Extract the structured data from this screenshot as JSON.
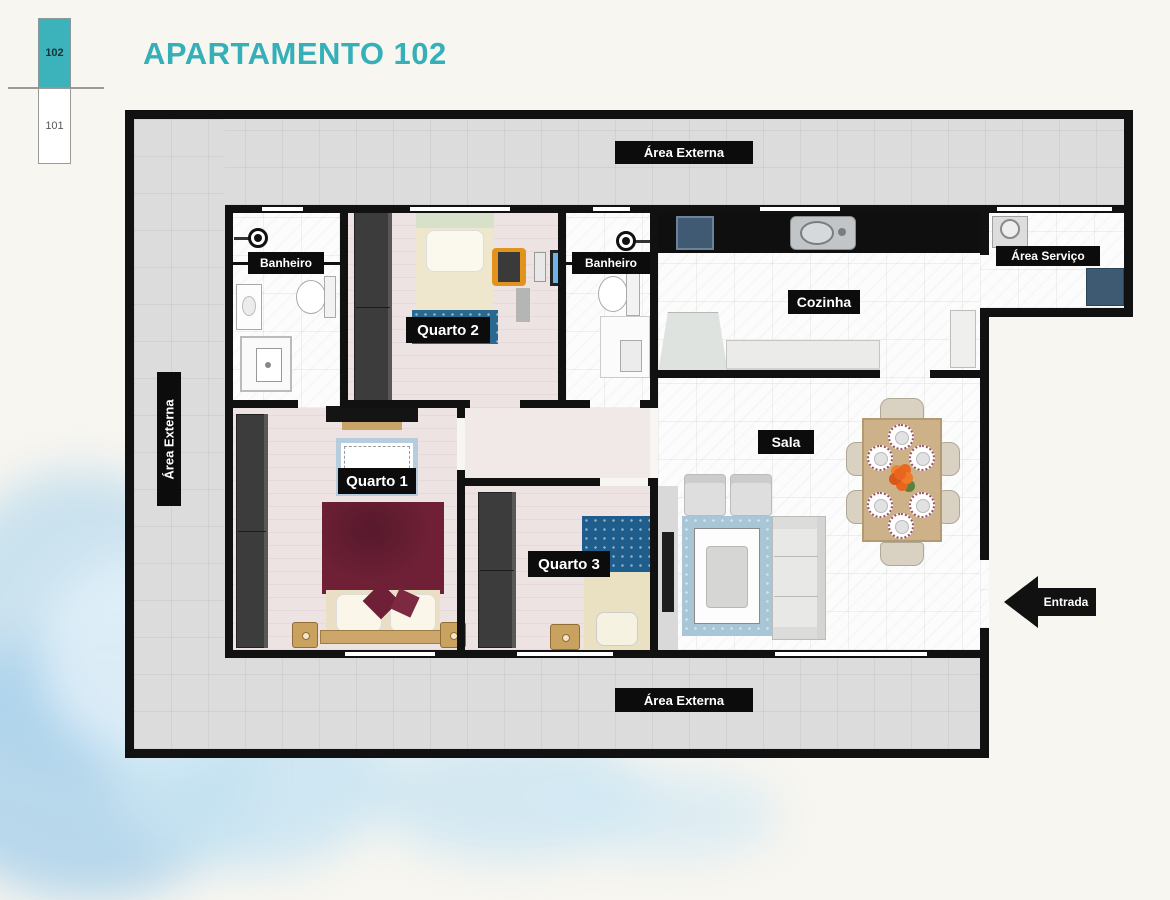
{
  "title": "APARTAMENTO 102",
  "unit_selector": {
    "selected": "102",
    "other": "101"
  },
  "floor_plan": {
    "rooms": {
      "banheiro": "Banheiro",
      "quarto1": "Quarto 1",
      "quarto2": "Quarto 2",
      "quarto3": "Quarto 3",
      "cozinha": "Cozinha",
      "sala": "Sala",
      "area_servico": "Área Serviço"
    },
    "outdoor_label": "Área Externa",
    "entrance_label": "Entrada",
    "colors": {
      "title_teal": "#35b0b8",
      "selected_unit_teal": "#3cb2ba",
      "wall_black": "#111111",
      "exterior_gray": "#dcdcdc",
      "bedroom_floor": "#ede3e2",
      "bed1_maroon": "#6f2037",
      "bed3_blanket_blue": "#1f5d8c",
      "quarto2_blanket_blue": "#29688f",
      "rug_blue": "#a8c6d6",
      "laundry_tank_blue": "#3d5a72",
      "wood_tan": "#c9a25f",
      "desk_chair_orange": "#e2931d",
      "watercolor_blue": "#cfe4f0"
    }
  }
}
